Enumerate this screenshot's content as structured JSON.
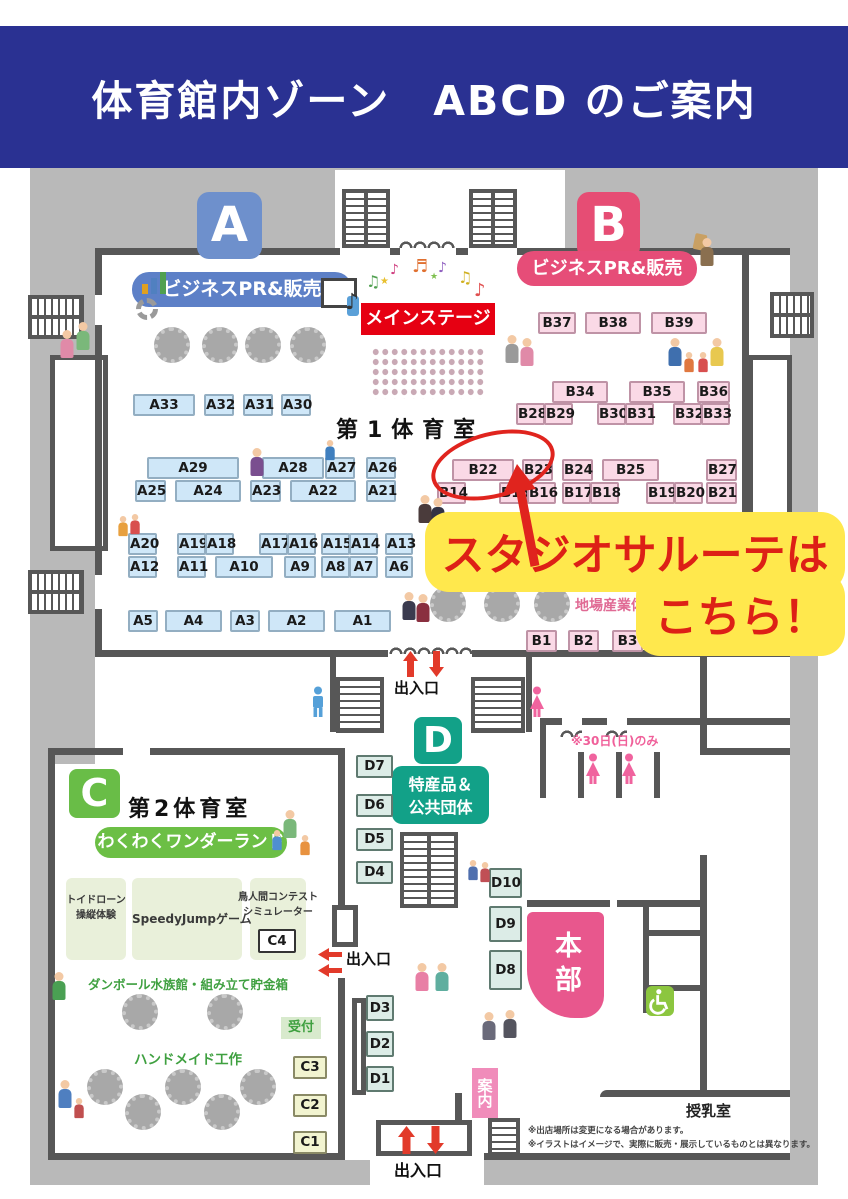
{
  "header": {
    "title": "体育館内ゾーン　ABCD のご案内"
  },
  "zone_badges": {
    "a": "A",
    "b": "B",
    "c": "C",
    "d": "D"
  },
  "areas": {
    "gym1": "第1体育室",
    "gym2": "第2体育室",
    "biz_pr_a": "ビジネスPR&販売",
    "biz_pr_b": "ビジネスPR&販売",
    "main_stage": "メインステージ",
    "wonder_land": "わくわくワンダーランド",
    "tokusan_line1": "特産品＆",
    "tokusan_line2": "公共団体",
    "jiba_sangyo": "地場産業体",
    "toy_drone_line1": "トイドローン",
    "toy_drone_line2": "操縦体験",
    "speedy_jump": "SpeedyJumpゲーム",
    "birdman_line1": "鳥人間コンテスト",
    "birdman_line2": "シミュレーター",
    "cardboard": "ダンボール水族館・組み立て貯金箱",
    "handmade": "ハンドメイド工作",
    "reception": "受付",
    "hq": "本部",
    "info": "案内",
    "nursing_room": "授乳室"
  },
  "entrances": {
    "top": "出入口",
    "left": "出入口",
    "bottom": "出入口"
  },
  "annotation": {
    "line1": "スタジオサルーテは",
    "line2": "こちら！"
  },
  "notices": {
    "sunday_only": "※30日(日)のみ",
    "note1": "※出店場所は変更になる場合があります。",
    "note2": "※イラストはイメージで、実際に販売・展示しているものとは異なります。"
  },
  "booths": {
    "A1": "A1",
    "A2": "A2",
    "A3": "A3",
    "A4": "A4",
    "A5": "A5",
    "A6": "A6",
    "A7": "A7",
    "A8": "A8",
    "A9": "A9",
    "A10": "A10",
    "A11": "A11",
    "A12": "A12",
    "A13": "A13",
    "A14": "A14",
    "A15": "A15",
    "A16": "A16",
    "A17": "A17",
    "A18": "A18",
    "A19": "A19",
    "A20": "A20",
    "A21": "A21",
    "A22": "A22",
    "A23": "A23",
    "A24": "A24",
    "A25": "A25",
    "A26": "A26",
    "A27": "A27",
    "A28": "A28",
    "A29": "A29",
    "A30": "A30",
    "A31": "A31",
    "A32": "A32",
    "A33": "A33",
    "B1": "B1",
    "B2": "B2",
    "B3": "B3",
    "B14": "B14",
    "B15": "B15",
    "B16": "B16",
    "B17": "B17",
    "B18": "B18",
    "B19": "B19",
    "B20": "B20",
    "B21": "B21",
    "B22": "B22",
    "B23": "B23",
    "B24": "B24",
    "B25": "B25",
    "B27": "B27",
    "B28": "B28",
    "B29": "B29",
    "B30": "B30",
    "B31": "B31",
    "B32": "B32",
    "B33": "B33",
    "B34": "B34",
    "B35": "B35",
    "B36": "B36",
    "B37": "B37",
    "B38": "B38",
    "B39": "B39",
    "C1": "C1",
    "C2": "C2",
    "C3": "C3",
    "C4": "C4",
    "D1": "D1",
    "D2": "D2",
    "D3": "D3",
    "D4": "D4",
    "D5": "D5",
    "D6": "D6",
    "D7": "D7",
    "D8": "D8",
    "D9": "D9",
    "D10": "D10"
  },
  "colors": {
    "header_navy": "#2a3192",
    "zone_a": "#6e90cc",
    "zone_b": "#e64d74",
    "zone_c": "#69bd47",
    "zone_d": "#12a188",
    "stage_red": "#e60012",
    "annotation_bg": "#ffe84d",
    "annotation_red": "#dd2016"
  }
}
